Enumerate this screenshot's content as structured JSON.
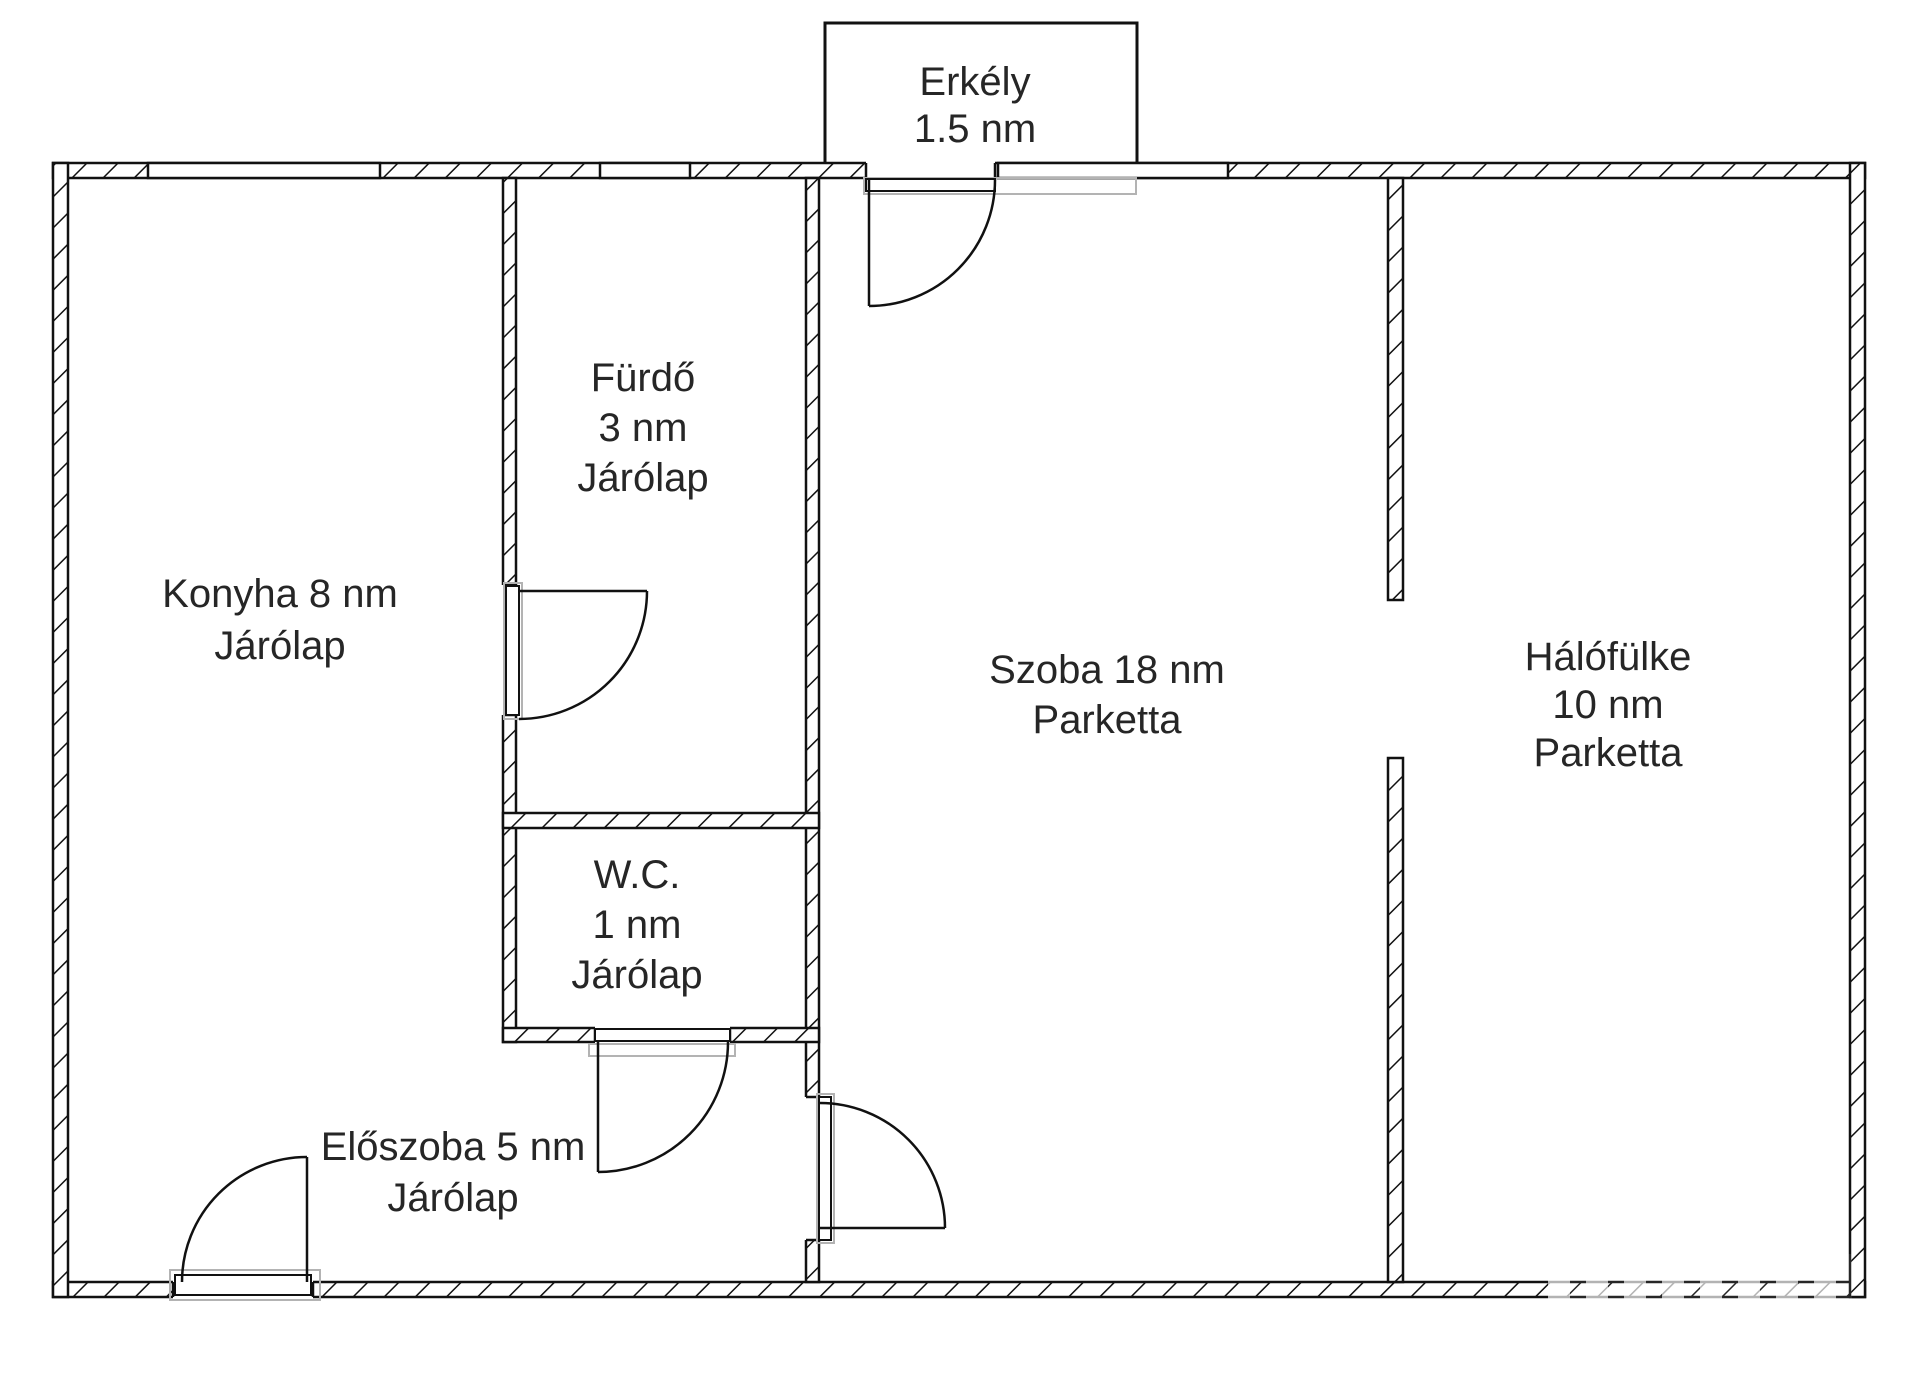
{
  "plan": {
    "type": "apartment-floor-plan",
    "units": "nm",
    "colors": {
      "wall_line": "#111111",
      "label_text": "#262626",
      "door_frame_gray": "#b3b3b3",
      "background": "#ffffff"
    }
  },
  "rooms": {
    "erkely": {
      "lines": [
        "Erkély",
        "1.5 nm"
      ]
    },
    "konyha": {
      "lines": [
        "Konyha 8 nm",
        "Járólap"
      ]
    },
    "furdo": {
      "lines": [
        "Fürdő",
        "3 nm",
        "Járólap"
      ]
    },
    "wc": {
      "lines": [
        "W.C.",
        "1 nm",
        "Járólap"
      ]
    },
    "eloszoba": {
      "lines": [
        "Előszoba 5 nm",
        "Járólap"
      ]
    },
    "szoba": {
      "lines": [
        "Szoba 18 nm",
        "Parketta"
      ]
    },
    "halofulke": {
      "lines": [
        "Hálófülke",
        "10 nm",
        "Parketta"
      ]
    }
  }
}
